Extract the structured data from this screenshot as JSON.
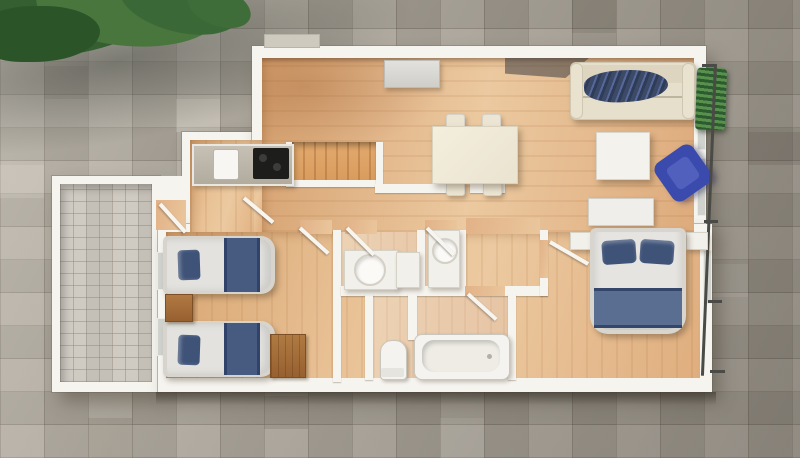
{
  "scene": {
    "kind": "3D rendered apartment floor plan, top-down view",
    "setting": "grey stone-paved courtyard, green shrub in top-left corner, shadow cast across paving",
    "building_shape": "white-walled apartment with wood flooring, walled patio annex on the left, balcony strip with railing and plant on the right",
    "rooms": [
      {
        "name": "terrace-patio",
        "floor": "small grey stone pavers",
        "furniture": []
      },
      {
        "name": "kitchen",
        "floor": "wood",
        "furniture": [
          "counter",
          "sink",
          "black cooktop"
        ]
      },
      {
        "name": "living-dining-room",
        "floor": "wood",
        "furniture": [
          "grey sideboard",
          "dining table",
          "four chairs",
          "cream sofa with blue patterned throw",
          "white coffee table",
          "blue armchair",
          "white dresser",
          "balcony plant"
        ]
      },
      {
        "name": "staircase-enclosure",
        "floor": "orange wood treads",
        "furniture": []
      },
      {
        "name": "twin-bedroom",
        "floor": "wood",
        "furniture": [
          "single bed with blue pillow and runner",
          "second single bed with blue pillow and runner",
          "wooden nightstand",
          "wooden chest"
        ]
      },
      {
        "name": "bathroom-center",
        "floor": "wood",
        "furniture": [
          "vanity with round basin",
          "tall white cabinet"
        ]
      },
      {
        "name": "wc",
        "floor": "wood",
        "furniture": [
          "washbasin with round bowl"
        ]
      },
      {
        "name": "family-bathroom",
        "floor": "wood",
        "furniture": [
          "toilet",
          "bathtub"
        ]
      },
      {
        "name": "master-bedroom",
        "floor": "wood",
        "furniture": [
          "double bed with two blue pillows and blue runner",
          "left nightstand",
          "right nightstand"
        ]
      },
      {
        "name": "hallway",
        "floor": "wood",
        "furniture": []
      }
    ],
    "doors_open": 7,
    "beds_total": 3
  },
  "palette": {
    "stone_light": "#b3ada2",
    "stone_dark": "#978f84",
    "wall_white": "#f6f4ef",
    "wood_light": "#ecc9a0",
    "wood_mid": "#dfae7e",
    "wood_dark": "#c08a5a",
    "patio_paver": "#cbc6bd",
    "sofa_cream": "#e6dfcc",
    "upholstery_blue": "#3f5378",
    "armchair_blue": "#3c4cae",
    "foliage_green": "#3c6a37",
    "cooktop_black": "#1d1d1b",
    "fixture_white": "#f2f0ea",
    "nightstand_wood": "#a8713d",
    "railing_dark": "#4a4a46"
  }
}
